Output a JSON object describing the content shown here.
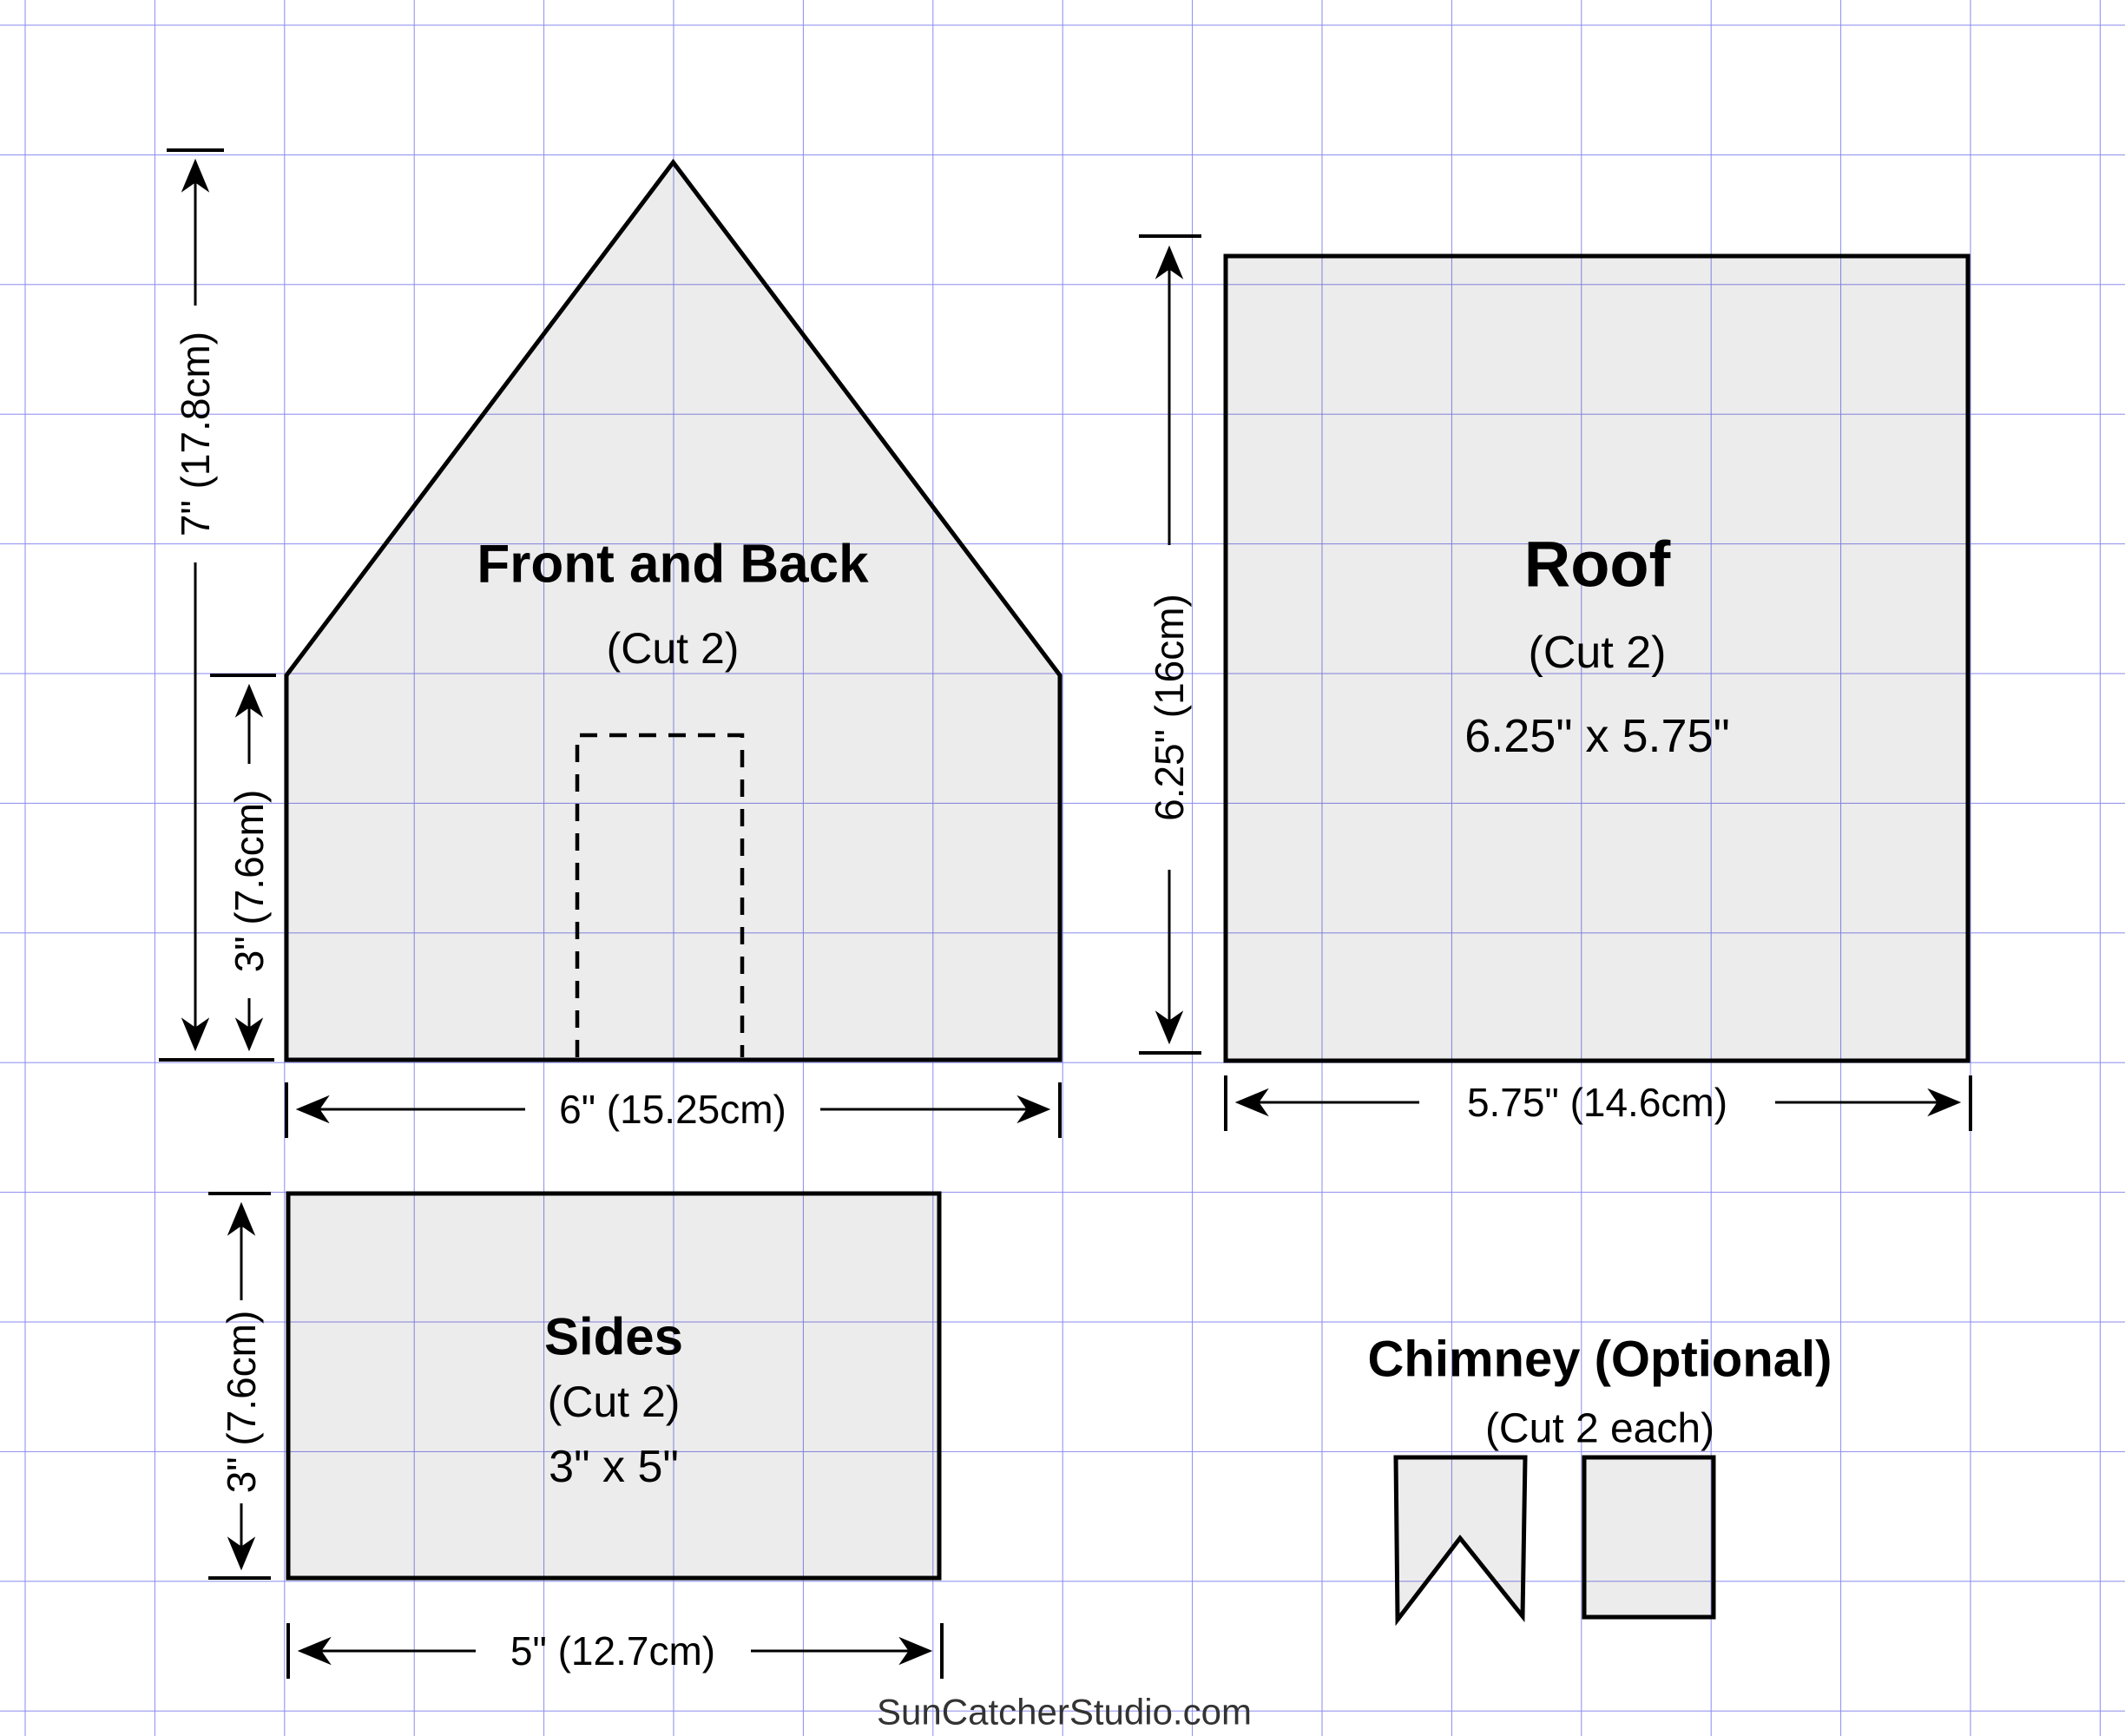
{
  "page": {
    "watermark": "SunCatcherStudio.com"
  },
  "pieces": {
    "front_back": {
      "title": "Front and Back",
      "cut": "(Cut 2)"
    },
    "roof": {
      "title": "Roof",
      "cut": "(Cut 2)",
      "size": "6.25\" x 5.75\""
    },
    "sides": {
      "title": "Sides",
      "cut": "(Cut 2)",
      "size": "3\" x 5\""
    },
    "chimney": {
      "title": "Chimney (Optional)",
      "cut": "(Cut 2 each)"
    }
  },
  "dimensions": {
    "front_total_height": "7\" (17.8cm)",
    "front_wall_height": "3\" (7.6cm)",
    "front_width": "6\" (15.25cm)",
    "roof_length": "6.25\" (16cm)",
    "roof_width": "5.75\" (14.6cm)",
    "side_height": "3\" (7.6cm)",
    "side_width": "5\" (12.7cm)"
  },
  "colors": {
    "grid": "#8a8aef",
    "outline": "#000000",
    "piece_fill": "#ececec",
    "watermark": "#333333"
  }
}
